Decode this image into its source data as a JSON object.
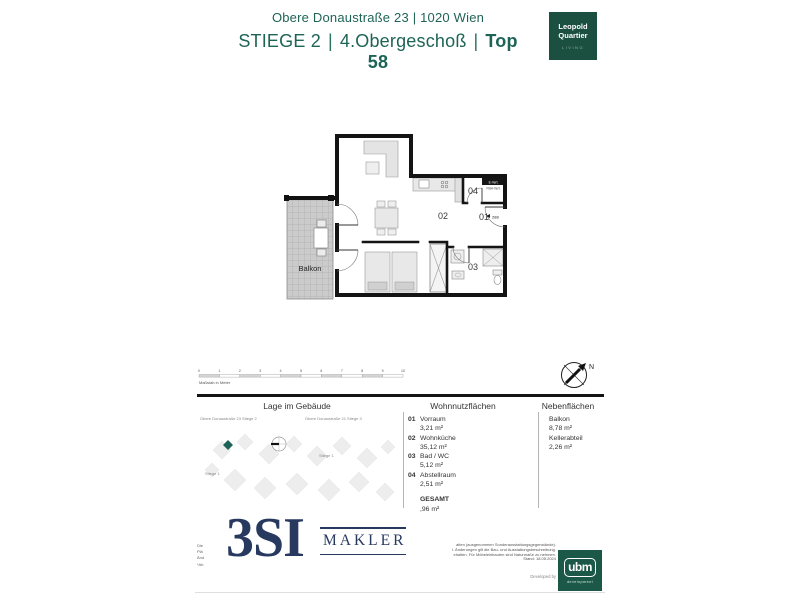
{
  "header": {
    "address": "Obere Donaustraße 23 | 1020 Wien",
    "stiege": "STIEGE 2",
    "sep1": "|",
    "floor": "4.Obergeschoß",
    "sep2": "|",
    "unit": "Top 58"
  },
  "brand_badge": {
    "line1": "Leopold",
    "line2": "Quartier",
    "line3": "LIVING"
  },
  "floorplan": {
    "room_labels": {
      "r01": "01",
      "r02": "02",
      "r03": "03",
      "r04": "04"
    },
    "balkon": "Balkon",
    "shaft_line1": "E-Vert.",
    "shaft_line2": "FBH-Vert.",
    "door_width": "288"
  },
  "scalebar": {
    "ticks": [
      "0",
      "1",
      "2",
      "3",
      "4",
      "5",
      "6",
      "7",
      "8",
      "9",
      "10"
    ],
    "label": "Maßstab in Meter"
  },
  "compass": {
    "north": "N"
  },
  "location": {
    "title": "Lage im Gebäude",
    "label_left": "Obere Donaustraße 23 Stiege 2",
    "label_right": "Obere Donaustraße 21 Stiege 3",
    "stiege_label_1": "Stiege 1",
    "stiege_label_2": "Stiege 1"
  },
  "wohnflaechen": {
    "title": "Wohnnutzflächen",
    "rows": [
      {
        "num": "01",
        "name": "Vorraum",
        "value": "3,21 m²"
      },
      {
        "num": "02",
        "name": "Wohnküche",
        "value": "35,12 m²"
      },
      {
        "num": "03",
        "name": "Bad / WC",
        "value": "5,12 m²"
      },
      {
        "num": "04",
        "name": "Abstellraum",
        "value": "2,51 m²"
      }
    ],
    "total_label": "GESAMT",
    "total_value": ",96 m²"
  },
  "nebenflaechen": {
    "title": "Nebenflächen",
    "rows": [
      {
        "name": "Balkon",
        "value": "8,78 m²"
      },
      {
        "name": "Kellerabteil",
        "value": "2,26 m²"
      }
    ]
  },
  "footer": {
    "logo_big": "3SI",
    "logo_sub": "MAKLER",
    "left_fragments": [
      "Die",
      "Plä",
      "Änd",
      "*Ab"
    ],
    "disclaimer_lines": [
      "alten (ausgenommen Sonderausstattungsgegenstände).",
      "l. Änderungen gilt die Bau- und Ausstattungsbeschreibung.",
      "ehalten. Für Möbeleinbauten sind Naturmaße zu nehmen.",
      "Stand: 18.05.2024"
    ],
    "developed_by": "Developed by",
    "ubm_line1": "ubm",
    "ubm_line2": "development"
  },
  "colors": {
    "teal": "#1E6456",
    "badge_green": "#1B4F3F",
    "navy": "#28395F",
    "ubm_green": "#1C5847",
    "marker_green": "#1E6456"
  }
}
